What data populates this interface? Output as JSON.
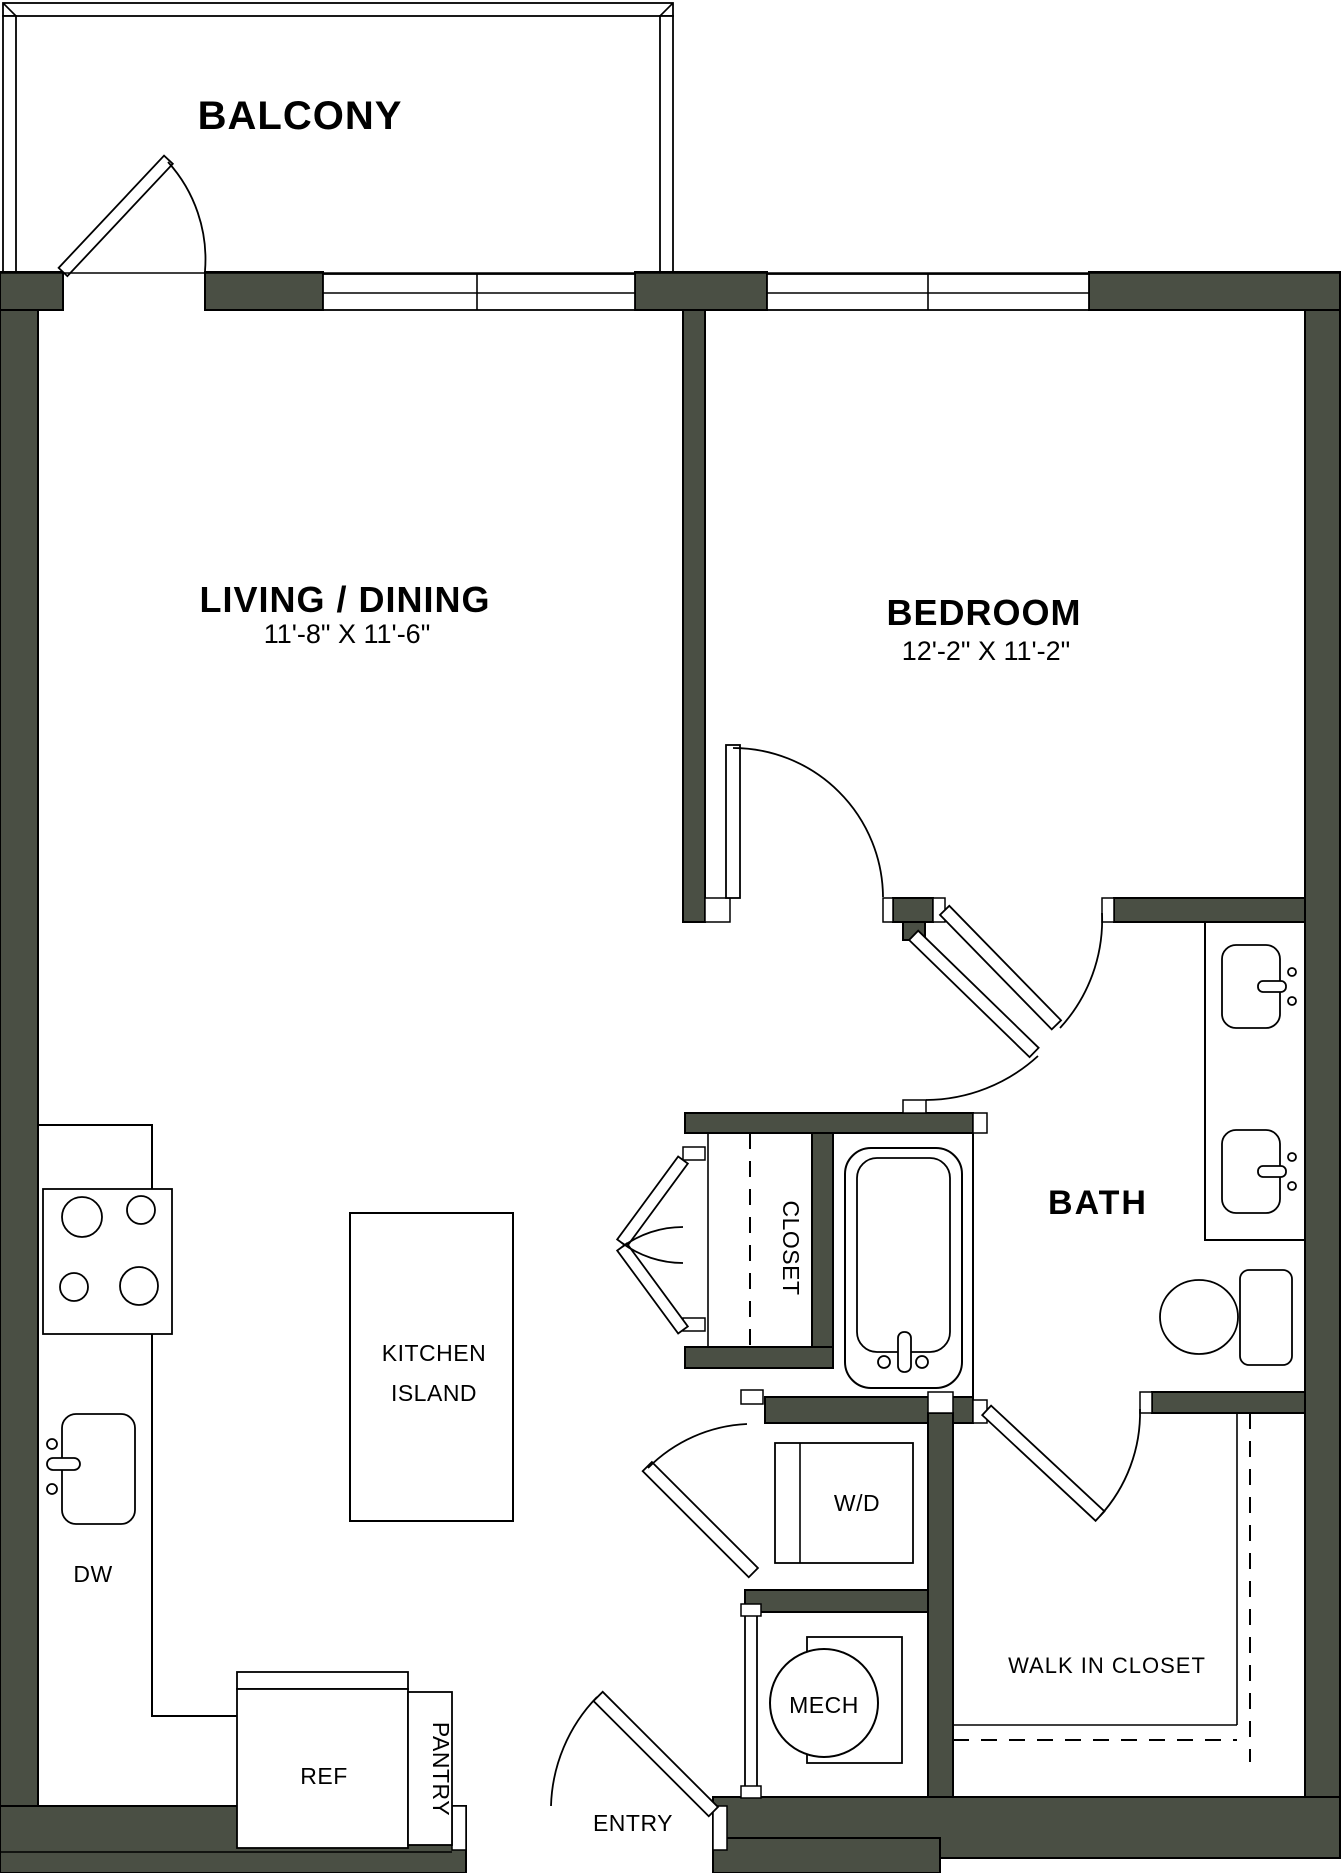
{
  "colors": {
    "wall": "#4a4f44",
    "line": "#000000",
    "background": "#ffffff"
  },
  "rooms": {
    "balcony": {
      "label": "BALCONY"
    },
    "living_dining": {
      "label": "LIVING / DINING",
      "dimensions": "11'-8\" X 11'-6\""
    },
    "bedroom": {
      "label": "BEDROOM",
      "dimensions": "12'-2\" X 11'-2\""
    },
    "bath": {
      "label": "BATH"
    },
    "closet": {
      "label": "CLOSET"
    },
    "walk_in_closet": {
      "label": "WALK IN CLOSET"
    },
    "entry": {
      "label": "ENTRY"
    }
  },
  "fixtures": {
    "kitchen_island": {
      "label_line1": "KITCHEN",
      "label_line2": "ISLAND"
    },
    "dishwasher": {
      "label": "DW"
    },
    "refrigerator": {
      "label": "REF"
    },
    "pantry": {
      "label": "PANTRY"
    },
    "washer_dryer": {
      "label": "W/D"
    },
    "mechanical": {
      "label": "MECH"
    }
  }
}
